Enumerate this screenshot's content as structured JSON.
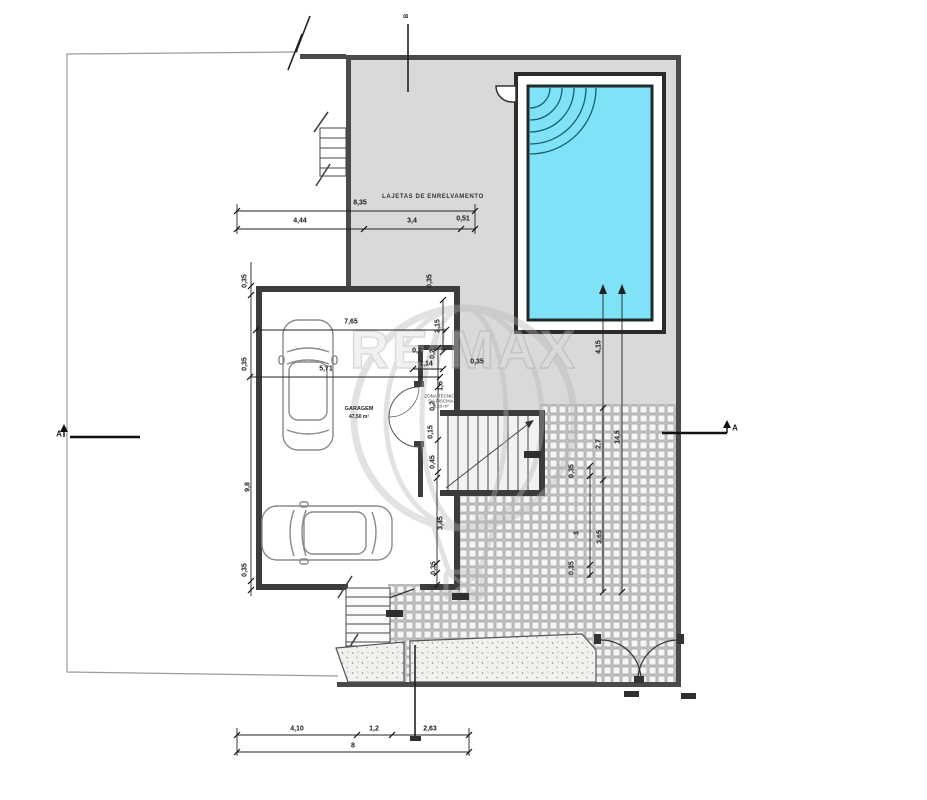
{
  "drawing": {
    "type": "architectural site / floor plan",
    "patio_label": "LAJETAS DE ENRELVAMENTO",
    "garage_name": "GARAGEM",
    "garage_area": "47,50 m²",
    "tech_room_line1": "ZONA TECNICA",
    "tech_room_line2": "DA PISCINA",
    "tech_room_line3": "2,10 m²"
  },
  "section_markers": {
    "left": "A",
    "right": "A",
    "top": "B"
  },
  "watermark": {
    "brand": "RE/MAX"
  },
  "colors": {
    "pool_water": "#7fe2f7",
    "pool_border": "#1f2a2d",
    "patio_gray": "#d9d9d9",
    "wall": "#3c3c3c",
    "boundary": "#9a9a9a",
    "tile_grout": "#909090",
    "watermark_gray": "#b5b5b5"
  },
  "dim_labels": [
    {
      "t": "8,35",
      "x": 360,
      "y": 203,
      "r": 0
    },
    {
      "t": "4,44",
      "x": 300,
      "y": 221,
      "r": 0
    },
    {
      "t": "3,4",
      "x": 412,
      "y": 221,
      "r": 0
    },
    {
      "t": "0,51",
      "x": 463,
      "y": 219,
      "r": 0
    },
    {
      "t": "0,35",
      "x": 245,
      "y": 281,
      "r": 90
    },
    {
      "t": "0,35",
      "x": 430,
      "y": 281,
      "r": 90
    },
    {
      "t": "7,65",
      "x": 351,
      "y": 322,
      "r": 0
    },
    {
      "t": "2,15",
      "x": 438,
      "y": 326,
      "r": 90
    },
    {
      "t": "0,35",
      "x": 245,
      "y": 364,
      "r": 90
    },
    {
      "t": "5,71",
      "x": 326,
      "y": 369,
      "r": 0
    },
    {
      "t": "0,2",
      "x": 417,
      "y": 351,
      "r": 0
    },
    {
      "t": "0,2",
      "x": 433,
      "y": 354,
      "r": 90
    },
    {
      "t": "1,14",
      "x": 426,
      "y": 364,
      "r": 0
    },
    {
      "t": "1,5",
      "x": 441,
      "y": 386,
      "r": 90
    },
    {
      "t": "0,2",
      "x": 433,
      "y": 406,
      "r": 90
    },
    {
      "t": "0,15",
      "x": 431,
      "y": 432,
      "r": 90
    },
    {
      "t": "0,45",
      "x": 433,
      "y": 462,
      "r": 90
    },
    {
      "t": "0,35",
      "x": 477,
      "y": 362,
      "r": 0
    },
    {
      "t": "9,8",
      "x": 248,
      "y": 487,
      "r": 90
    },
    {
      "t": "0,35",
      "x": 245,
      "y": 570,
      "r": 90
    },
    {
      "t": "3,45",
      "x": 441,
      "y": 523,
      "r": 90
    },
    {
      "t": "0,35",
      "x": 434,
      "y": 568,
      "r": 90
    },
    {
      "t": "4,15",
      "x": 599,
      "y": 347,
      "r": 90
    },
    {
      "t": "2,7",
      "x": 599,
      "y": 444,
      "r": 90
    },
    {
      "t": "3,65",
      "x": 600,
      "y": 537,
      "r": 90
    },
    {
      "t": "14,5",
      "x": 618,
      "y": 437,
      "r": 90
    },
    {
      "t": "0,35",
      "x": 572,
      "y": 471,
      "r": 90
    },
    {
      "t": "3",
      "x": 577,
      "y": 533,
      "r": 90
    },
    {
      "t": "0,35",
      "x": 572,
      "y": 568,
      "r": 90
    },
    {
      "t": "4,10",
      "x": 297,
      "y": 729,
      "r": 0
    },
    {
      "t": "1,2",
      "x": 374,
      "y": 729,
      "r": 0
    },
    {
      "t": "2,63",
      "x": 430,
      "y": 729,
      "r": 0
    },
    {
      "t": "8",
      "x": 353,
      "y": 746,
      "r": 0
    }
  ]
}
